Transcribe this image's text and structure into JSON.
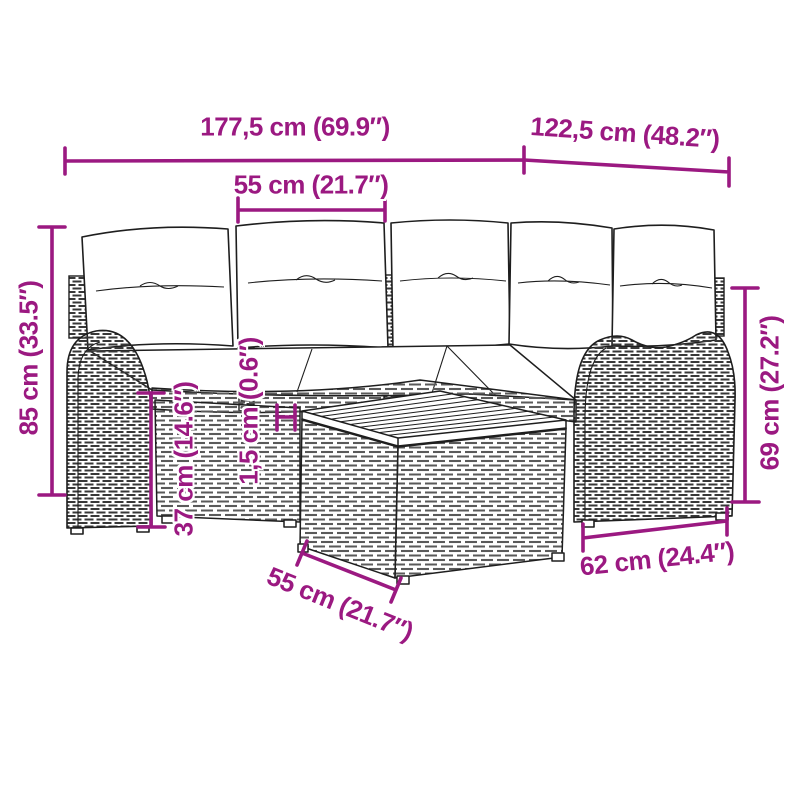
{
  "colors": {
    "dimension_accent": "#9B1981",
    "line_art": "#1E1E1E",
    "background": "#FFFFFF"
  },
  "dimensions": {
    "sofa_total_width": {
      "label": "177,5 cm (69.9″)"
    },
    "sofa_total_depth": {
      "label": "122,5 cm (48.2″)"
    },
    "seat_width": {
      "label": "55 cm (21.7″)"
    },
    "sofa_total_height": {
      "label": "85 cm (33.5″)"
    },
    "seat_height": {
      "label": "37 cm (14.6″)"
    },
    "cushion_thickness": {
      "label": "1,5 cm (0.6″)"
    },
    "armrest_height": {
      "label": "69 cm (27.2″)"
    },
    "table_width": {
      "label": "62 cm (24.4″)"
    },
    "table_depth": {
      "label": "55 cm (21.7″)"
    }
  }
}
